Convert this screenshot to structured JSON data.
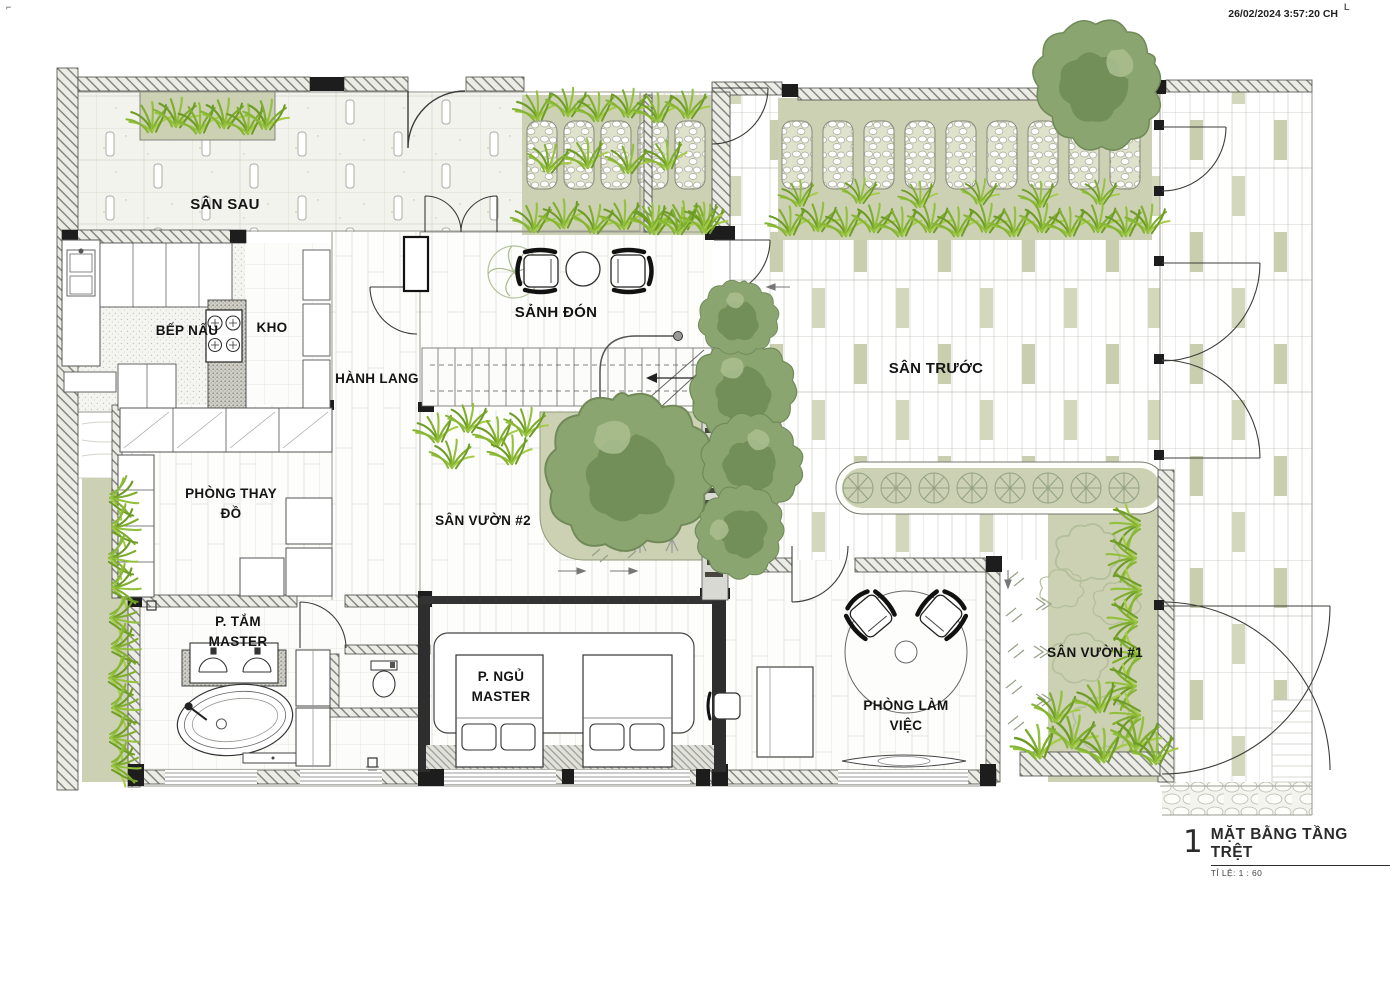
{
  "sheet": {
    "timestamp": "26/02/2024 3:57:20 CH",
    "corner_mark_left": "⌐",
    "corner_mark_right": "L"
  },
  "rooms": {
    "san_sau": "SÂN SAU",
    "bep_nau": "BẾP NẤU",
    "kho": "KHO",
    "hanh_lang": "HÀNH LANG",
    "sanh_don": "SẢNH ĐÓN",
    "san_truoc": "SÂN TRƯỚC",
    "phong_thay_do_line1": "PHÒNG THAY",
    "phong_thay_do_line2": "ĐỒ",
    "san_vuon_2": "SÂN VƯỜN #2",
    "p_tam_line1": "P. TẮM",
    "p_tam_line2": "MASTER",
    "p_ngu_line1": "P. NGỦ",
    "p_ngu_line2": "MASTER",
    "phong_lam_viec_line1": "PHÒNG LÀM",
    "phong_lam_viec_line2": "VIỆC",
    "san_vuon_1": "SÂN VƯỜN #1"
  },
  "title_block": {
    "number": "1",
    "title": "MẶT BẰNG TẦNG TRỆT",
    "scale_label": "TỈ LỆ: 1 : 60"
  },
  "colors": {
    "garden_bed": "#ccd1b3",
    "grass_green": "#7fae2e",
    "tree_canopy": "#8ba571",
    "wall_dark": "#1d1d1d",
    "paper": "#ffffff"
  }
}
